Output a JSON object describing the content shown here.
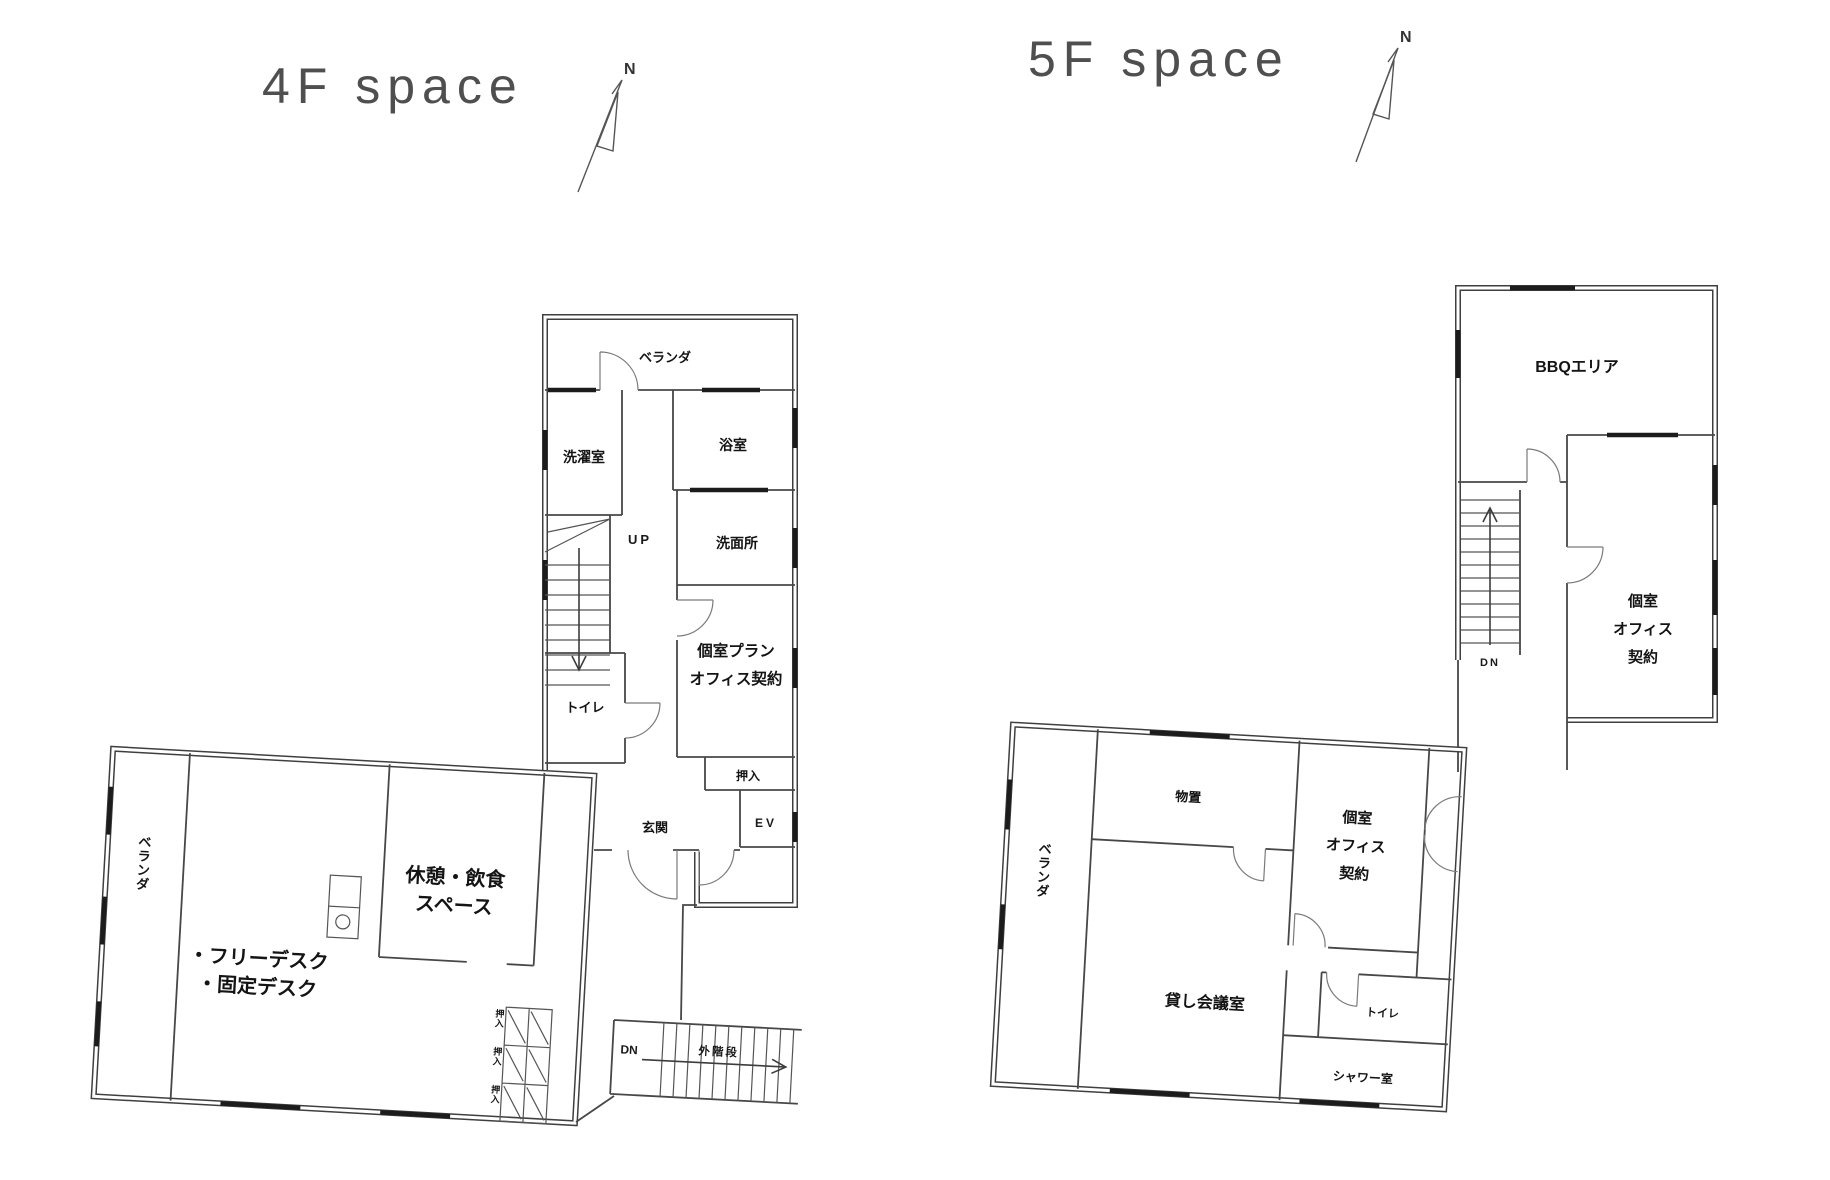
{
  "floor4": {
    "title": "4F space",
    "compass": "N",
    "tower": {
      "veranda": "ベランダ",
      "laundry": "洗濯室",
      "bath": "浴室",
      "washroom": "洗面所",
      "up": "UP",
      "toilet": "トイレ",
      "office_l1": "個室プラン",
      "office_l2": "オフィス契約",
      "closet": "押入",
      "entrance": "玄関",
      "elevator": "EV"
    },
    "wing": {
      "veranda": "ベランダ",
      "lounge_l1": "休憩・飲食",
      "lounge_l2": "スペース",
      "desks_l1": "・フリーデスク",
      "desks_l2": "・固定デスク",
      "closet1": "押入",
      "closet2": "押入",
      "closet3": "押入",
      "dn": "DN",
      "ext_stairs": "外階段"
    }
  },
  "floor5": {
    "title": "5F space",
    "compass": "N",
    "upper": {
      "bbq": "BBQエリア",
      "dn": "DN",
      "office_l1": "個室",
      "office_l2": "オフィス",
      "office_l3": "契約"
    },
    "wing": {
      "veranda": "ベランダ",
      "storage": "物置",
      "office_l1": "個室",
      "office_l2": "オフィス",
      "office_l3": "契約",
      "meeting": "貸し会議室",
      "toilet": "トイレ",
      "shower": "シャワー室"
    }
  }
}
